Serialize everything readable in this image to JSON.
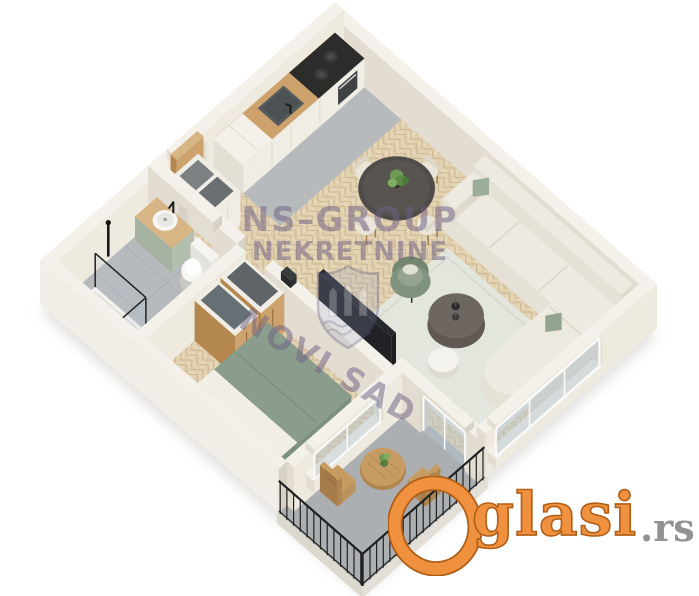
{
  "image": {
    "type": "real-estate-3d-floorplan-render",
    "background": "#ffffff"
  },
  "watermark": {
    "line1": "NS–GROUP",
    "line2": "NEKRETNINE",
    "line3": "NOVI SAD",
    "color": "#6d6085",
    "shield_fill": "#97a0c4",
    "shield_stroke": "#5c557e"
  },
  "logo": {
    "initial": "O",
    "rest": "glasi",
    "tld": ".rs",
    "color": "#f09140",
    "outline": "#b05f17",
    "tld_color": "#929292"
  },
  "palette": {
    "wall_top": "#f4f1ea",
    "wall_light": "#efeae0",
    "wall_dark": "#e2dcd1",
    "wall_cut": "#d7d0c4",
    "wall_outer": "#f1eee8",
    "floor_gray": "#b7babc",
    "floor_gray_dark": "#acafb2",
    "parquet_base": "#e5d6b6",
    "parquet_dark": "#d9c6a2",
    "parquet_line": "#cdb996",
    "wood": "#cda26c",
    "wood_dark": "#b4874f",
    "wood_light": "#d7b584",
    "cabinet_white": "#f0ede5",
    "counter_dark": "#2c2c2a",
    "sink_metal": "#575c5f",
    "sofa_top": "#edeae1",
    "sofa_x": "#dfdacd",
    "sofa_y": "#e6e1d6",
    "pillow_green": "#9cad99",
    "rug": "#e3e6dd",
    "table_dark": "#504c49",
    "coffee_dark": "#6e6661",
    "chair_cream": "#eae5da",
    "chair_leg": "#a37a4a",
    "arm_green": "#7f937e",
    "arm_green_light": "#95a492",
    "bed_green": "#7d9180",
    "bed_green_light": "#8a9c8b",
    "bed_frame": "#eeebe3",
    "vanity_green": "#b3bfae",
    "white": "#f8f6f2",
    "glass": "#b6c6d0",
    "railing": "#212122",
    "balcony_wood": "#c79c63",
    "plant_green": "#6f9a55",
    "tv_dark": "#202225",
    "shadow": "#c9c6c1"
  }
}
